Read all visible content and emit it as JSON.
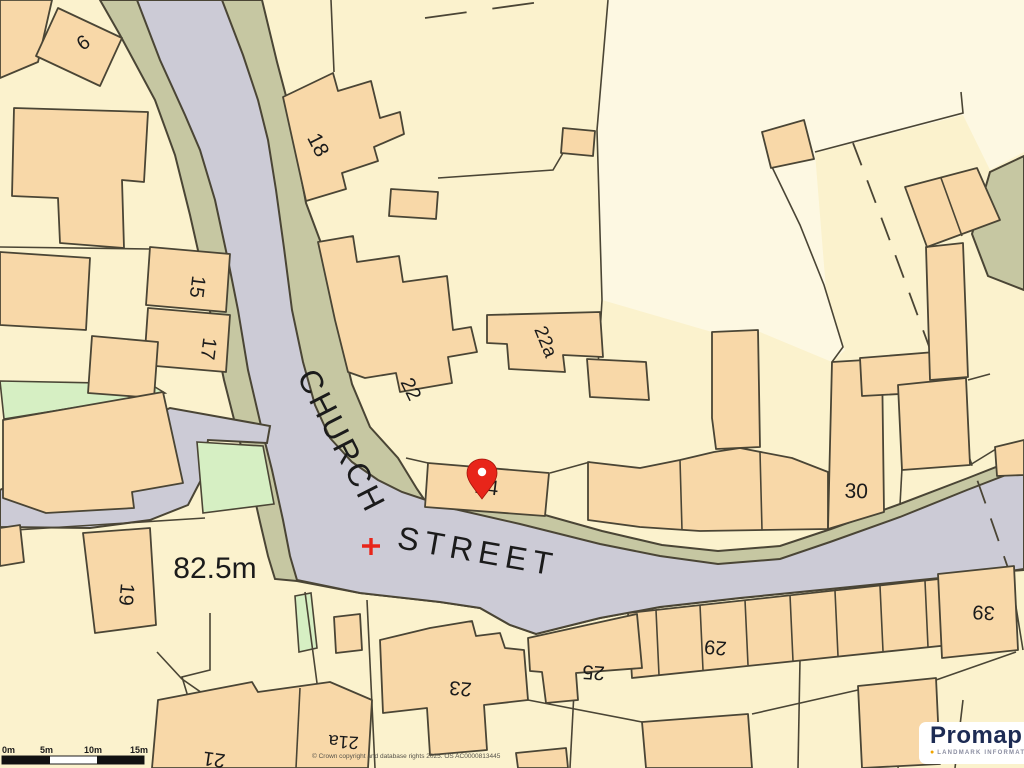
{
  "map": {
    "street_labels": [
      {
        "t": "CHURCH",
        "x": 332,
        "y": 446,
        "r": 63,
        "s": 32,
        "ls": 3
      },
      {
        "t": "STREET",
        "x": 476,
        "y": 562,
        "r": 10,
        "s": 32,
        "ls": 6
      }
    ],
    "labels": [
      {
        "t": "6",
        "x": 87,
        "y": 48,
        "r": -35,
        "s": 20
      },
      {
        "t": "18",
        "x": 312,
        "y": 148,
        "r": 63,
        "s": 21
      },
      {
        "t": "15",
        "x": 191,
        "y": 286,
        "r": 97,
        "s": 20
      },
      {
        "t": "17",
        "x": 202,
        "y": 348,
        "r": 97,
        "s": 20
      },
      {
        "t": "22",
        "x": 405,
        "y": 392,
        "r": 64,
        "s": 20
      },
      {
        "t": "22a",
        "x": 540,
        "y": 344,
        "r": 68,
        "s": 19
      },
      {
        "t": "24",
        "x": 486,
        "y": 494,
        "r": 7,
        "s": 21
      },
      {
        "t": "30",
        "x": 856,
        "y": 498,
        "r": 2,
        "s": 21
      },
      {
        "t": "19",
        "x": 120,
        "y": 594,
        "r": 95,
        "s": 20
      },
      {
        "t": "82.5m",
        "x": 215,
        "y": 578,
        "r": 0,
        "s": 30
      },
      {
        "t": "21",
        "x": 215,
        "y": 753,
        "r": 188,
        "s": 20
      },
      {
        "t": "21a",
        "x": 344,
        "y": 736,
        "r": 184,
        "s": 18
      },
      {
        "t": "23",
        "x": 461,
        "y": 682,
        "r": 185,
        "s": 20
      },
      {
        "t": "25",
        "x": 594,
        "y": 666,
        "r": 184,
        "s": 20
      },
      {
        "t": "29",
        "x": 716,
        "y": 641,
        "r": 185,
        "s": 20
      },
      {
        "t": "39",
        "x": 984,
        "y": 606,
        "r": 183,
        "s": 20
      }
    ],
    "marker": {
      "type": "location-pin",
      "color": "#E8251A"
    },
    "crosshair": {
      "color": "#F02F1F"
    }
  },
  "scalebar": {
    "labels": [
      "0m",
      "5m",
      "10m",
      "15m"
    ]
  },
  "footer": {
    "copyright": "© Crown copyright and database rights 2025. OS AC0000813445"
  },
  "brand": {
    "name": "Promap",
    "tagline": "LANDMARK INFORMATION",
    "dot": "●"
  },
  "colors": {
    "land": "#FBF2CD",
    "landLight": "#FDF8E2",
    "building": "#F8D8A8",
    "road": "#CCCBD6",
    "verge": "#C6C7A2",
    "green": "#D6EFC3",
    "line": "#4A4535",
    "red": "#E8251A",
    "navy": "#1C2B54",
    "brandOrange": "#F0A500"
  }
}
